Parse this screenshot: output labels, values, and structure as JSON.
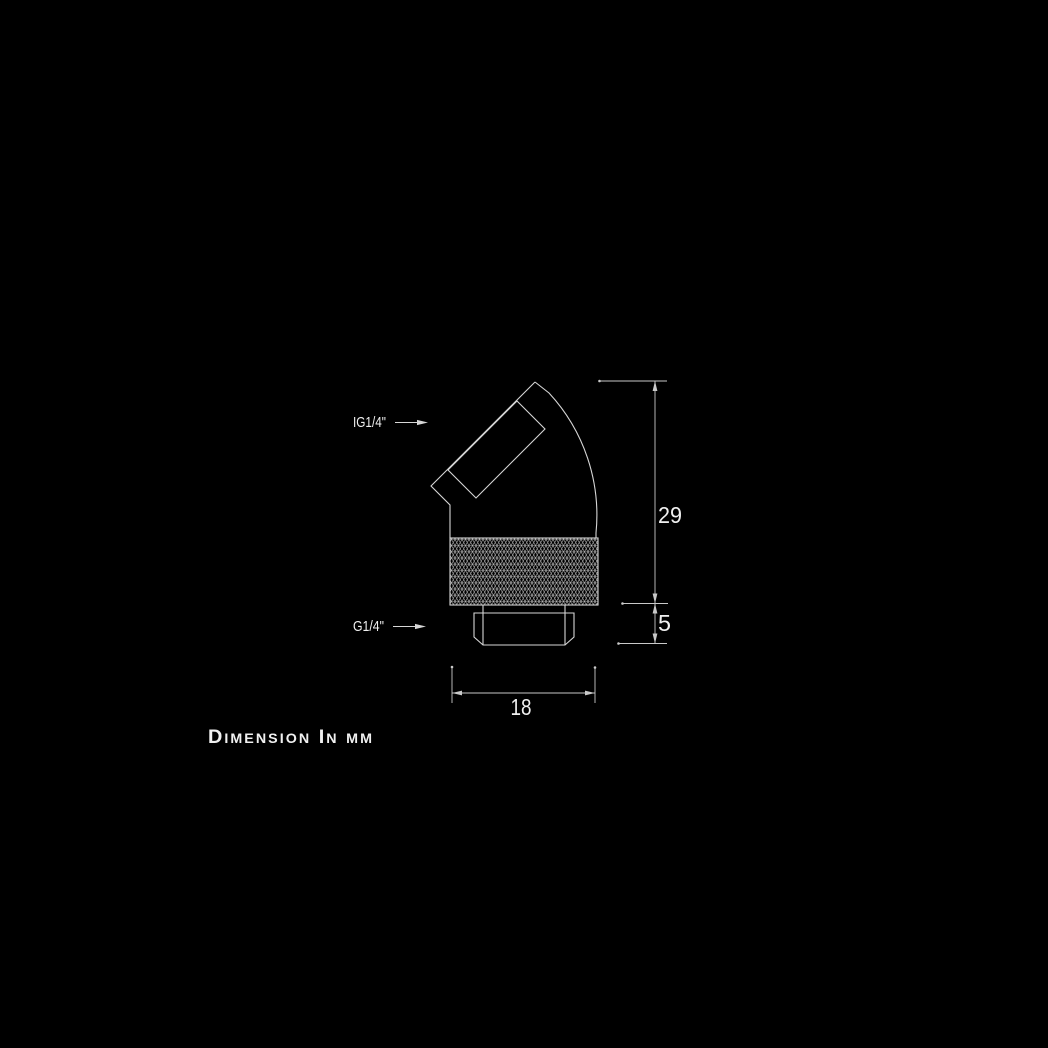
{
  "colors": {
    "background": "#000000",
    "line": "#d6d6d6",
    "dim_line": "#c9c9c9",
    "text": "#f0f0f0"
  },
  "annotations": {
    "inlet_label": "IG1/4\"",
    "outlet_label": "G1/4\"",
    "footer_note": "Dimension In mm"
  },
  "dimensions_mm": {
    "body_height": "29",
    "thread_height": "5",
    "body_width": "18"
  }
}
